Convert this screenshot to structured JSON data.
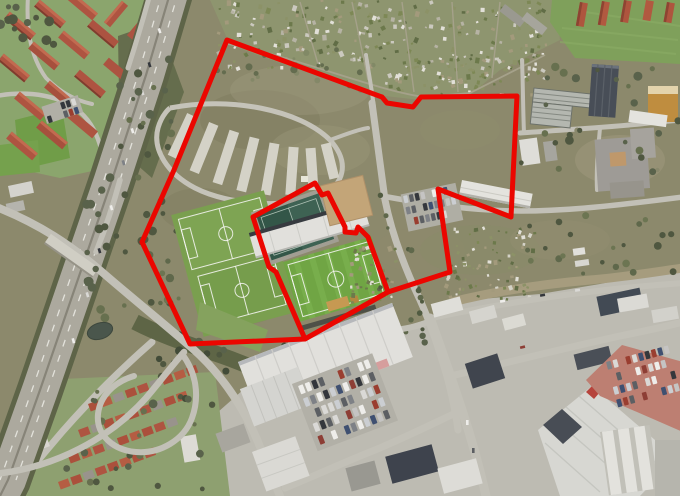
{
  "meta": {
    "description": "Aerial satellite photograph with red site-boundary overlay",
    "width": 680,
    "height": 496
  },
  "overlay": {
    "stroke_color": "#eb0600",
    "stroke_width": 5,
    "outer_boundary": {
      "label": "outer-site-boundary",
      "points": "227,40 382,97 387,103 413,107 421,97 517,96 511,217 438,189 450,272 388,292 305,339 190,344 142,242 174,170"
    },
    "stadium_boundary": {
      "label": "stadium-parcel-boundary",
      "points": "253,217 315,183 322,195 328,193 345,227 345,232 356,233 358,227 368,237 388,292 305,339 276,272 269,267"
    }
  },
  "map": {
    "type": "satellite-aerial-photo",
    "features": [
      "motorway-with-interchange",
      "residential-apartment-blocks",
      "allotment-gardens",
      "overflow-parking-area",
      "football-pitches",
      "stadium-with-stands",
      "sand-pitch",
      "scrubland",
      "cemetery-gardens",
      "industrial-estate",
      "retail-halls",
      "car-parking-lots",
      "terraced-housing",
      "pond"
    ],
    "palette": {
      "scrub": "#8d8b6d",
      "grass": "#8ca86e",
      "pitch": "#6fa843",
      "dark_pitch": "#2f5547",
      "sand": "#c7a87a",
      "asphalt": "#aeaca2",
      "road": "#c6c5bc",
      "urban": "#c0bfb7",
      "roof_white": "#e6e6e3",
      "roof_red": "#b05340",
      "roof_dark": "#3d434d",
      "red_lot": "#c08073",
      "pond": "#47554b",
      "tree": "#57614a",
      "cars": [
        "#f4f4f2",
        "#dfdfdd",
        "#c9c9c9",
        "#30343a",
        "#7e8288",
        "#8e3b33",
        "#3c4f72",
        "#cfd3d8",
        "#5a5e64",
        "#9b3b2e"
      ]
    }
  }
}
